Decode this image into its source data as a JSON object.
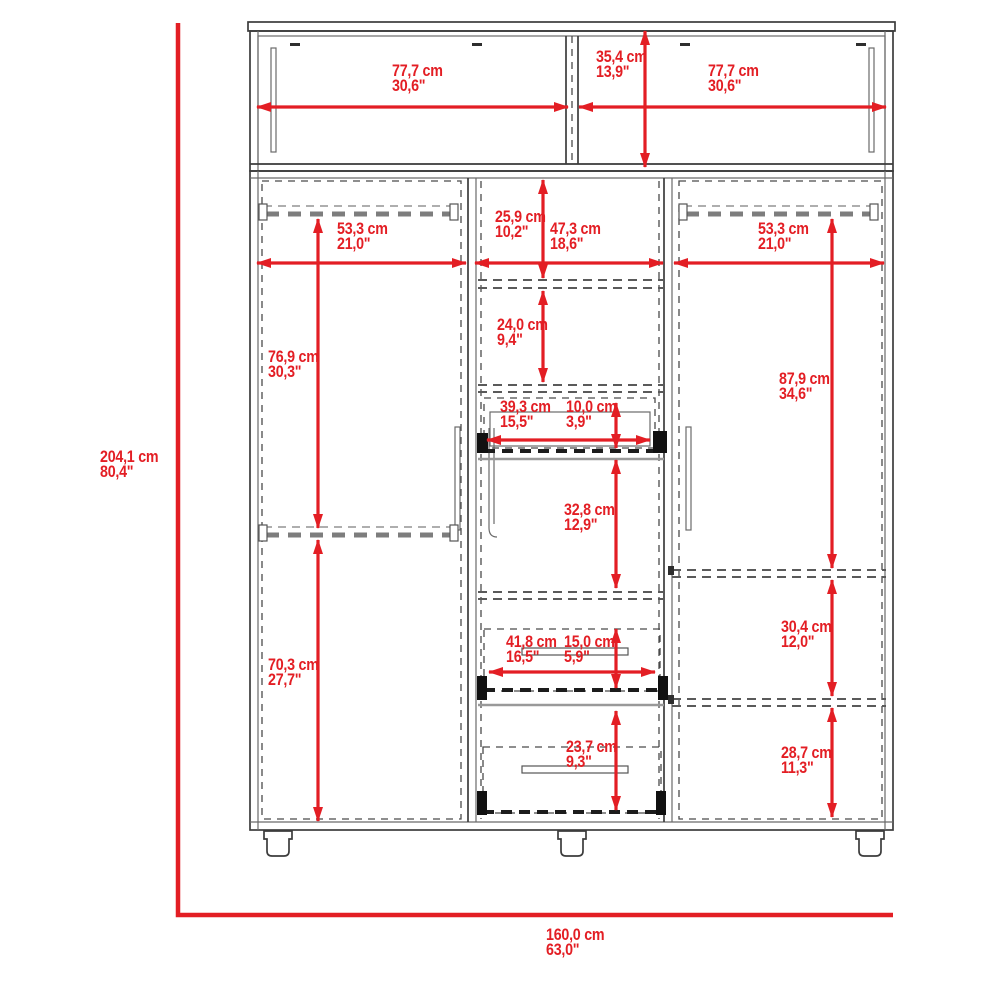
{
  "figure": {
    "type": "furniture-dimension-diagram",
    "product": "three-door wardrobe with drawers and top hutch",
    "units": "cm / inches",
    "accent_color": "#e31e24",
    "line_color": "#3c3c3c"
  },
  "dims": {
    "overall_height": {
      "cm": "204,1 cm",
      "inch": "80,4\""
    },
    "overall_width": {
      "cm": "160,0 cm",
      "inch": "63,0\""
    },
    "hutch_left_width": {
      "cm": "77,7 cm",
      "inch": "30,6\""
    },
    "hutch_height": {
      "cm": "35,4 cm",
      "inch": "13,9\""
    },
    "hutch_right_width": {
      "cm": "77,7 cm",
      "inch": "30,6\""
    },
    "left_width": {
      "cm": "53,3 cm",
      "inch": "21,0\""
    },
    "center_top_gap": {
      "cm": "25,9 cm",
      "inch": "10,2\""
    },
    "center_width": {
      "cm": "47,3 cm",
      "inch": "18,6\""
    },
    "right_width": {
      "cm": "53,3 cm",
      "inch": "21,0\""
    },
    "left_upper_height": {
      "cm": "76,9 cm",
      "inch": "30,3\""
    },
    "center_shelf_gap": {
      "cm": "24,0 cm",
      "inch": "9,4\""
    },
    "tray_width": {
      "cm": "39,3 cm",
      "inch": "15,5\""
    },
    "tray_height": {
      "cm": "10,0 cm",
      "inch": "3,9\""
    },
    "center_mid_height": {
      "cm": "32,8 cm",
      "inch": "12,9\""
    },
    "drawer_width": {
      "cm": "41,8 cm",
      "inch": "16,5\""
    },
    "drawer_height": {
      "cm": "15,0 cm",
      "inch": "5,9\""
    },
    "bottom_drawer_height": {
      "cm": "23,7 cm",
      "inch": "9,3\""
    },
    "left_lower_height": {
      "cm": "70,3 cm",
      "inch": "27,7\""
    },
    "right_upper_height": {
      "cm": "87,9 cm",
      "inch": "34,6\""
    },
    "right_mid_height": {
      "cm": "30,4 cm",
      "inch": "12,0\""
    },
    "right_lower_height": {
      "cm": "28,7 cm",
      "inch": "11,3\""
    }
  }
}
